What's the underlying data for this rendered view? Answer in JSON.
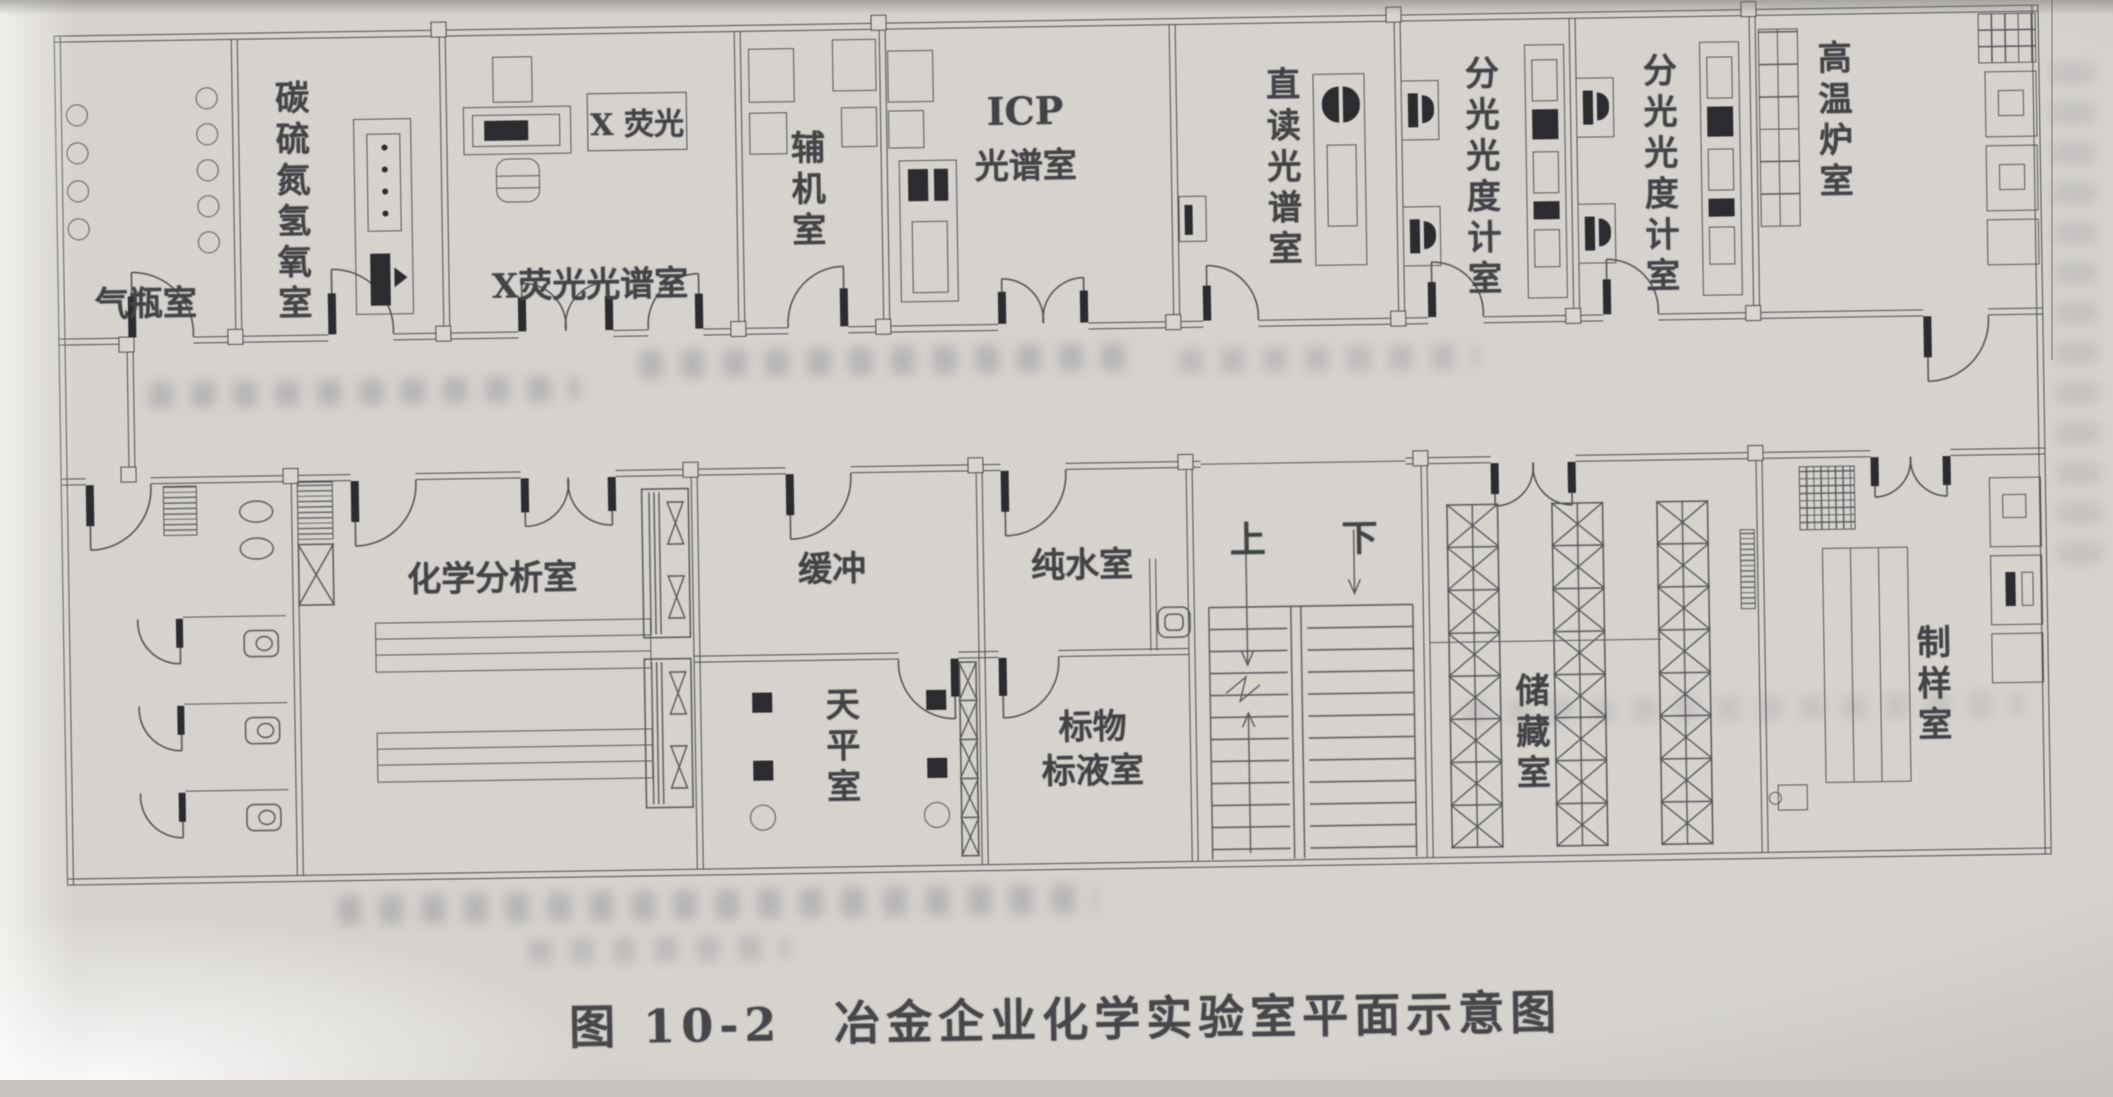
{
  "caption": {
    "figure_no": "图 10-2",
    "title": "冶金企业化学实验室平面示意图"
  },
  "rooms": {
    "top": [
      {
        "name": "gas-cylinder-room",
        "label": "气瓶室"
      },
      {
        "name": "carbon-sulfur-nitrogen-hydrogen-oxygen-room",
        "label": "碳硫氮氢氧室"
      },
      {
        "name": "xrf-spectroscopy-room",
        "label": "X荧光光谱室",
        "instrument_tag": "X 荧光"
      },
      {
        "name": "auxiliary-equipment-room",
        "label": "辅机室"
      },
      {
        "name": "icp-spectroscopy-room",
        "label_line1": "ICP",
        "label_line2": "光谱室"
      },
      {
        "name": "direct-reading-spectroscopy-room",
        "label": "直读光谱室"
      },
      {
        "name": "spectrophotometer-room-1",
        "label": "分光光度计室"
      },
      {
        "name": "spectrophotometer-room-2",
        "label": "分光光度计室"
      },
      {
        "name": "high-temperature-furnace-room",
        "label": "高温炉室"
      }
    ],
    "bottom": [
      {
        "name": "chemical-analysis-room",
        "label": "化学分析室"
      },
      {
        "name": "buffer-room",
        "label": "缓冲"
      },
      {
        "name": "balance-room",
        "label": "天平室"
      },
      {
        "name": "pure-water-room",
        "label": "纯水室"
      },
      {
        "name": "standard-material-solution-room",
        "label_line1": "标物",
        "label_line2": "标液室"
      },
      {
        "name": "storage-room",
        "label": "储藏室"
      },
      {
        "name": "sample-preparation-room",
        "label": "制样室"
      }
    ]
  },
  "stairs": {
    "up_label": "上",
    "down_label": "下"
  }
}
